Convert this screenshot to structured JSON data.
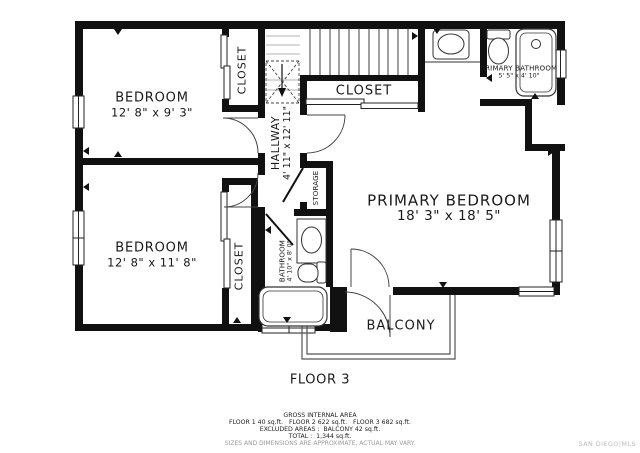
{
  "floorplan": {
    "rooms": {
      "bedroom_1": {
        "name": "BEDROOM",
        "dims": "12' 8\" x 9' 3\""
      },
      "bedroom_2": {
        "name": "BEDROOM",
        "dims": "12' 8\" x 11' 8\""
      },
      "primary_bedroom": {
        "name": "PRIMARY BEDROOM",
        "dims": "18' 3\" x 18' 5\""
      },
      "primary_bathroom": {
        "name": "PRIMARY BATHROOM",
        "dims": "5' 5\" x 4' 10\""
      },
      "bathroom": {
        "name": "BATHROOM",
        "dims": "4' 10\" x 8' 0\""
      },
      "hallway": {
        "name": "HALLWAY",
        "dims": "4' 11\" x 12' 11\""
      },
      "closet_bedroom_1": {
        "name": "CLOSET"
      },
      "closet_bedroom_2": {
        "name": "CLOSET"
      },
      "closet_hall": {
        "name": "CLOSET"
      },
      "storage": {
        "name": "STORAGE"
      },
      "balcony": {
        "name": "BALCONY"
      }
    },
    "floor_label": "FLOOR 3",
    "area_summary": {
      "title": "GROSS INTERNAL AREA",
      "floors_line": "FLOOR 1 40 sq.ft.   FLOOR 2 622 sq.ft.   FLOOR 3 682 sq.ft.",
      "excluded_line": "EXCLUDED AREAS :  BALCONY 42 sq.ft.",
      "total_line": "TOTAL :  1,344 sq.ft.",
      "disclaimer": "SIZES AND DIMENSIONS ARE APPROXIMATE, ACTUAL MAY VARY."
    },
    "watermark": "SAN DIEGO|MLS",
    "colors": {
      "wall": "#111111",
      "line": "#333333",
      "muted": "#9a9a9a",
      "watermark": "#bdbdbd"
    }
  }
}
